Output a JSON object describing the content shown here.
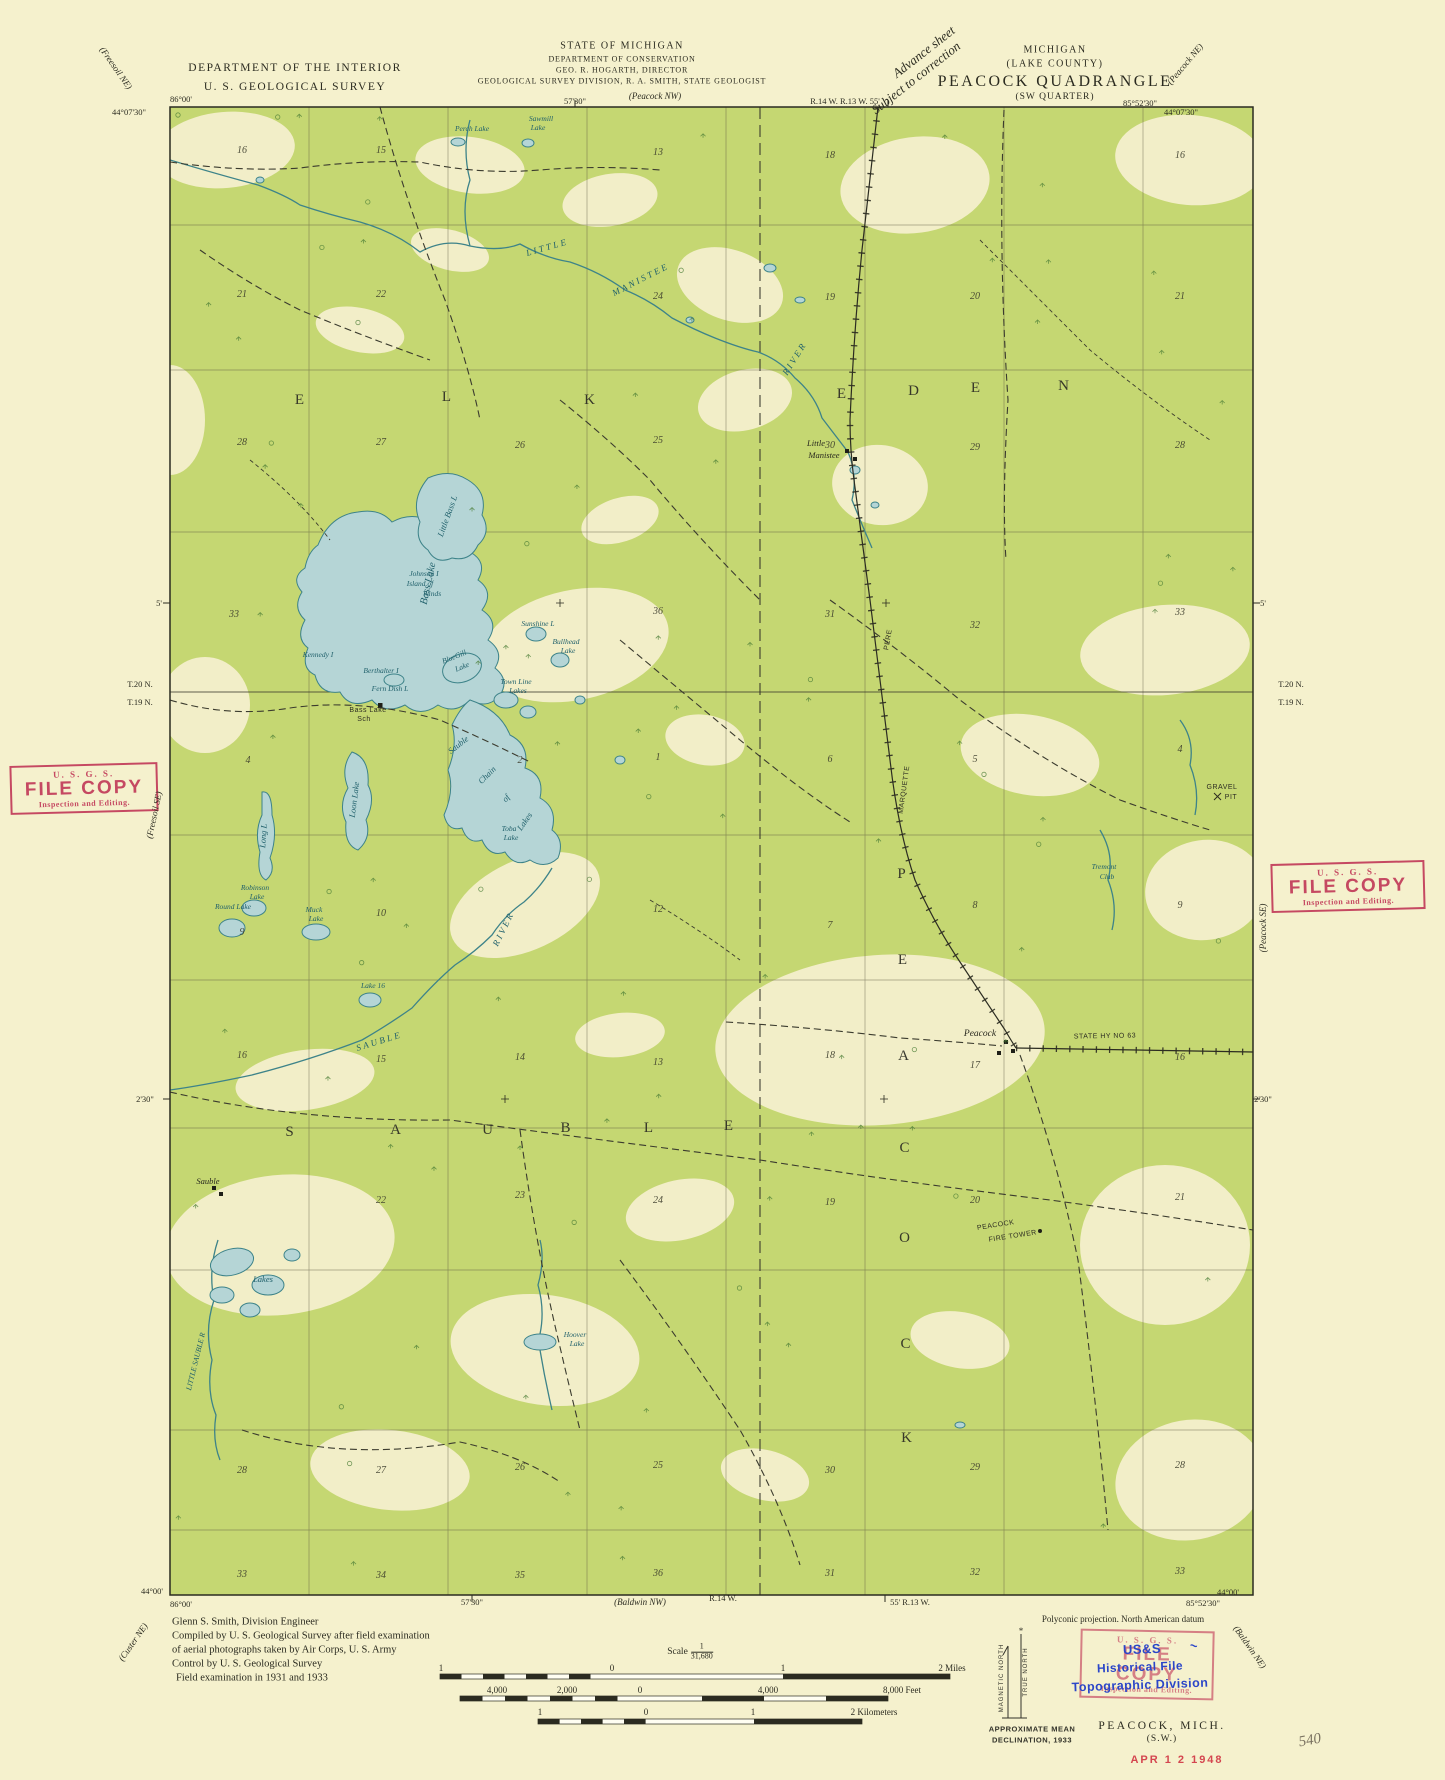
{
  "colors": {
    "paper": "#f5f1cd",
    "map_green": "#c5d772",
    "clearing": "#f2eec8",
    "water_fill": "#b5d5d6",
    "water_line": "#3d8389",
    "stamp_red": "#c23b59",
    "stamp_blue": "#2b46c8",
    "ink": "#2b2b20"
  },
  "header": {
    "dept1": "DEPARTMENT OF THE INTERIOR",
    "dept2": "U. S. GEOLOGICAL SURVEY",
    "state1": "STATE OF MICHIGAN",
    "state2": "DEPARTMENT OF CONSERVATION",
    "state3": "GEO. R. HOGARTH, DIRECTOR",
    "state4": "GEOLOGICAL SURVEY DIVISION, R. A. SMITH, STATE GEOLOGIST",
    "note1": "Advance sheet",
    "note2": "Subject to correction",
    "right1": "MICHIGAN",
    "right2": "(LAKE COUNTY)",
    "right3": "PEACOCK QUADRANGLE",
    "right4": "(SW QUARTER)"
  },
  "stamps": {
    "file_copy": {
      "l1": "U. S. G. S.",
      "l2": "FILE COPY",
      "l3": "Inspection and Editing."
    },
    "historical": {
      "b1": "US&S",
      "b2": "Historical File",
      "b3": "Topographic Division",
      "mark": "~"
    },
    "date": "APR 1 2 1948",
    "pencil": "540"
  },
  "scale": {
    "word": "Scale",
    "num": "1",
    "den": "31,680"
  },
  "floating_texts": [
    {
      "t": "86°00'",
      "x": 181,
      "y": 99
    },
    {
      "t": "44°07'30\"",
      "x": 129,
      "y": 112
    },
    {
      "t": "57'30\"",
      "x": 575,
      "y": 101
    },
    {
      "t": "(Peacock NW)",
      "x": 655,
      "y": 96,
      "c": "ital"
    },
    {
      "t": "R.14 W. R.13 W. 55'",
      "x": 845,
      "y": 101
    },
    {
      "t": "85°52'30\"",
      "x": 1140,
      "y": 103
    },
    {
      "t": "44°07'30\"",
      "x": 1181,
      "y": 112
    },
    {
      "t": "(Peacock NE)",
      "x": 1185,
      "y": 64,
      "r": -50,
      "c": "ital"
    },
    {
      "t": "(Freesoil NE)",
      "x": 116,
      "y": 68,
      "r": 55,
      "c": "ital"
    },
    {
      "t": "5'",
      "x": 159,
      "y": 603
    },
    {
      "t": "T.20 N.",
      "x": 140,
      "y": 684
    },
    {
      "t": "T.19 N.",
      "x": 140,
      "y": 702
    },
    {
      "t": "(Freesoil SE)",
      "x": 154,
      "y": 815,
      "r": -78,
      "c": "ital"
    },
    {
      "t": "2'30\"",
      "x": 145,
      "y": 1099
    },
    {
      "t": "(Custer NE)",
      "x": 133,
      "y": 1642,
      "r": -55,
      "c": "ital"
    },
    {
      "t": "5'",
      "x": 1263,
      "y": 603
    },
    {
      "t": "T.20 N.",
      "x": 1291,
      "y": 684
    },
    {
      "t": "T.19 N.",
      "x": 1291,
      "y": 702
    },
    {
      "t": "(Peacock SE)",
      "x": 1263,
      "y": 928,
      "r": -90,
      "c": "ital"
    },
    {
      "t": "2'30\"",
      "x": 1263,
      "y": 1099
    },
    {
      "t": "(Baldwin NE)",
      "x": 1250,
      "y": 1647,
      "r": 55,
      "c": "ital"
    },
    {
      "t": "44°00'",
      "x": 152,
      "y": 1591
    },
    {
      "t": "86°00'",
      "x": 181,
      "y": 1604
    },
    {
      "t": "57'30\"",
      "x": 472,
      "y": 1602
    },
    {
      "t": "(Baldwin NW)",
      "x": 640,
      "y": 1602,
      "c": "ital"
    },
    {
      "t": "R.14 W.",
      "x": 723,
      "y": 1598
    },
    {
      "t": "55' R.13 W.",
      "x": 910,
      "y": 1602
    },
    {
      "t": "85°52'30\"",
      "x": 1203,
      "y": 1603
    },
    {
      "t": "44°00'",
      "x": 1228,
      "y": 1592
    },
    {
      "t": "Glenn S. Smith, Division Engineer",
      "x": 172,
      "y": 1622,
      "c": "cred"
    },
    {
      "t": "Compiled by U. S. Geological Survey after field examination",
      "x": 172,
      "y": 1636,
      "c": "cred"
    },
    {
      "t": "of aerial photographs taken by Air Corps, U. S. Army",
      "x": 172,
      "y": 1650,
      "c": "cred"
    },
    {
      "t": "Control by U. S. Geological Survey",
      "x": 172,
      "y": 1664,
      "c": "cred"
    },
    {
      "t": "Field examination in 1931 and 1933",
      "x": 176,
      "y": 1678,
      "c": "cred"
    },
    {
      "t": "1",
      "x": 441,
      "y": 1668,
      "c": "scl"
    },
    {
      "t": "0",
      "x": 612,
      "y": 1668,
      "c": "scl"
    },
    {
      "t": "1",
      "x": 783,
      "y": 1668,
      "c": "scl"
    },
    {
      "t": "2 Miles",
      "x": 952,
      "y": 1668,
      "c": "scl"
    },
    {
      "t": "4,000",
      "x": 497,
      "y": 1690,
      "c": "scl"
    },
    {
      "t": "2,000",
      "x": 567,
      "y": 1690,
      "c": "scl"
    },
    {
      "t": "0",
      "x": 640,
      "y": 1690,
      "c": "scl"
    },
    {
      "t": "4,000",
      "x": 768,
      "y": 1690,
      "c": "scl"
    },
    {
      "t": "8,000 Feet",
      "x": 902,
      "y": 1690,
      "c": "scl"
    },
    {
      "t": "1",
      "x": 540,
      "y": 1712,
      "c": "scl"
    },
    {
      "t": "0",
      "x": 646,
      "y": 1712,
      "c": "scl"
    },
    {
      "t": "1",
      "x": 753,
      "y": 1712,
      "c": "scl"
    },
    {
      "t": "2 Kilometers",
      "x": 874,
      "y": 1712,
      "c": "scl"
    },
    {
      "t": "Polyconic projection.    North American datum",
      "x": 1123,
      "y": 1619,
      "c": "proj"
    },
    {
      "t": "MAGNETIC NORTH",
      "x": 1002,
      "y": 1678,
      "r": -90,
      "c": "decl2"
    },
    {
      "t": "TRUE NORTH",
      "x": 1026,
      "y": 1672,
      "r": -90,
      "c": "decl2"
    },
    {
      "t": "APPROXIMATE MEAN",
      "x": 1032,
      "y": 1729,
      "c": "decl"
    },
    {
      "t": "DECLINATION, 1933",
      "x": 1032,
      "y": 1740,
      "c": "decl"
    },
    {
      "t": "PEACOCK, MICH.",
      "x": 1162,
      "y": 1726,
      "c": "sheet"
    },
    {
      "t": "(S.W.)",
      "x": 1162,
      "y": 1739,
      "c": "sheet2"
    },
    {
      "t": "540",
      "x": 1310,
      "y": 1741,
      "r": -10,
      "c": "pencil"
    },
    {
      "t": "APR 1 2 1948",
      "x": 1177,
      "y": 1760,
      "c": "date"
    }
  ],
  "map_labels": [
    {
      "t": "Perch Lake",
      "x": 472,
      "y": 131,
      "c": "ws"
    },
    {
      "t": "Sawmill",
      "x": 541,
      "y": 121,
      "c": "ws"
    },
    {
      "t": "Lake",
      "x": 538,
      "y": 130,
      "c": "ws"
    },
    {
      "t": "LITTLE",
      "x": 548,
      "y": 250,
      "r": -16,
      "c": "wr"
    },
    {
      "t": "MANISTEE",
      "x": 642,
      "y": 282,
      "r": -27,
      "c": "wr"
    },
    {
      "t": "RIVER",
      "x": 797,
      "y": 360,
      "r": -58,
      "c": "wr"
    },
    {
      "t": "E",
      "x": 300,
      "y": 404,
      "c": "t"
    },
    {
      "t": "L",
      "x": 447,
      "y": 401,
      "c": "t"
    },
    {
      "t": "K",
      "x": 590,
      "y": 404,
      "c": "t"
    },
    {
      "t": "E",
      "x": 842,
      "y": 398,
      "c": "t"
    },
    {
      "t": "D",
      "x": 914,
      "y": 395,
      "c": "t"
    },
    {
      "t": "E",
      "x": 976,
      "y": 392,
      "c": "t"
    },
    {
      "t": "N",
      "x": 1064,
      "y": 390,
      "c": "t"
    },
    {
      "t": "Little",
      "x": 816,
      "y": 446,
      "c": "p"
    },
    {
      "t": "Manistee",
      "x": 824,
      "y": 458,
      "c": "p"
    },
    {
      "t": "Little Bass L",
      "x": 450,
      "y": 517,
      "r": -70,
      "c": "w"
    },
    {
      "t": "Bass Lake",
      "x": 431,
      "y": 584,
      "r": -78,
      "c": "w",
      "s": 10.5
    },
    {
      "t": "Johnson I",
      "x": 424,
      "y": 576,
      "c": "ws"
    },
    {
      "t": "Island of",
      "x": 420,
      "y": 586,
      "c": "ws"
    },
    {
      "t": "Winds",
      "x": 432,
      "y": 596,
      "c": "ws"
    },
    {
      "t": "Kennedy I",
      "x": 318,
      "y": 657,
      "c": "ws"
    },
    {
      "t": "Berthalter I",
      "x": 381,
      "y": 673,
      "c": "ws"
    },
    {
      "t": "Fern Dish L",
      "x": 390,
      "y": 691,
      "c": "ws"
    },
    {
      "t": "Bass Lake",
      "x": 368,
      "y": 712,
      "c": "ps"
    },
    {
      "t": "Sch",
      "x": 364,
      "y": 721,
      "c": "ps"
    },
    {
      "t": "BlueGill",
      "x": 455,
      "y": 659,
      "r": -22,
      "c": "ws"
    },
    {
      "t": "Lake",
      "x": 463,
      "y": 669,
      "r": -22,
      "c": "ws"
    },
    {
      "t": "Town Line",
      "x": 516,
      "y": 684,
      "c": "ws"
    },
    {
      "t": "Lakes",
      "x": 518,
      "y": 693,
      "c": "ws"
    },
    {
      "t": "Sunshine L",
      "x": 538,
      "y": 626,
      "c": "ws"
    },
    {
      "t": "Bullhead",
      "x": 566,
      "y": 644,
      "c": "ws"
    },
    {
      "t": "Lake",
      "x": 568,
      "y": 653,
      "c": "ws"
    },
    {
      "t": "Sauble",
      "x": 460,
      "y": 747,
      "r": -38,
      "c": "w"
    },
    {
      "t": "Chain",
      "x": 489,
      "y": 777,
      "r": -45,
      "c": "w"
    },
    {
      "t": "of",
      "x": 508,
      "y": 800,
      "r": -50,
      "c": "w"
    },
    {
      "t": "Lakes",
      "x": 527,
      "y": 823,
      "r": -55,
      "c": "w"
    },
    {
      "t": "Toba",
      "x": 509,
      "y": 831,
      "c": "ws"
    },
    {
      "t": "Lake",
      "x": 511,
      "y": 840,
      "c": "ws"
    },
    {
      "t": "Loon Lake",
      "x": 357,
      "y": 800,
      "r": -83,
      "c": "w"
    },
    {
      "t": "Long L",
      "x": 266,
      "y": 836,
      "r": -86,
      "c": "w"
    },
    {
      "t": "Robinson",
      "x": 255,
      "y": 890,
      "c": "ws"
    },
    {
      "t": "Lake",
      "x": 257,
      "y": 899,
      "c": "ws"
    },
    {
      "t": "Round Lake",
      "x": 233,
      "y": 909,
      "c": "ws"
    },
    {
      "t": "Muck",
      "x": 314,
      "y": 912,
      "c": "ws"
    },
    {
      "t": "Lake",
      "x": 316,
      "y": 921,
      "c": "ws"
    },
    {
      "t": "Lake 16",
      "x": 373,
      "y": 988,
      "c": "ws"
    },
    {
      "t": "RIVER",
      "x": 506,
      "y": 930,
      "r": -64,
      "c": "wr"
    },
    {
      "t": "SAUBLE",
      "x": 380,
      "y": 1044,
      "r": -17,
      "c": "wr"
    },
    {
      "t": "S",
      "x": 290,
      "y": 1136,
      "c": "t"
    },
    {
      "t": "A",
      "x": 396,
      "y": 1134,
      "c": "t"
    },
    {
      "t": "U",
      "x": 488,
      "y": 1134,
      "c": "t"
    },
    {
      "t": "B",
      "x": 566,
      "y": 1132,
      "c": "t"
    },
    {
      "t": "L",
      "x": 649,
      "y": 1132,
      "c": "t"
    },
    {
      "t": "E",
      "x": 729,
      "y": 1130,
      "c": "t"
    },
    {
      "t": "P",
      "x": 902,
      "y": 878,
      "c": "t"
    },
    {
      "t": "E",
      "x": 903,
      "y": 964,
      "c": "t"
    },
    {
      "t": "A",
      "x": 904,
      "y": 1060,
      "c": "t"
    },
    {
      "t": "C",
      "x": 905,
      "y": 1152,
      "c": "t"
    },
    {
      "t": "O",
      "x": 905,
      "y": 1242,
      "c": "t"
    },
    {
      "t": "C",
      "x": 906,
      "y": 1348,
      "c": "t"
    },
    {
      "t": "K",
      "x": 907,
      "y": 1442,
      "c": "t"
    },
    {
      "t": "PERE",
      "x": 890,
      "y": 640,
      "r": -80,
      "c": "ps"
    },
    {
      "t": "MARQUETTE",
      "x": 906,
      "y": 790,
      "r": -82,
      "c": "ps"
    },
    {
      "t": "Sauble",
      "x": 208,
      "y": 1184,
      "c": "p"
    },
    {
      "t": "Peacock",
      "x": 980,
      "y": 1036,
      "c": "p",
      "s": 9.5
    },
    {
      "t": "STATE  HY  NO 63",
      "x": 1105,
      "y": 1038,
      "r": -1,
      "c": "ps"
    },
    {
      "t": "GRAVEL",
      "x": 1222,
      "y": 789,
      "c": "ps"
    },
    {
      "t": "PIT",
      "x": 1231,
      "y": 799,
      "c": "ps"
    },
    {
      "t": "Tremont",
      "x": 1104,
      "y": 869,
      "c": "ws"
    },
    {
      "t": "Club",
      "x": 1107,
      "y": 879,
      "c": "ws"
    },
    {
      "t": "PEACOCK",
      "x": 996,
      "y": 1227,
      "r": -9,
      "c": "ps"
    },
    {
      "t": "FIRE TOWER",
      "x": 1013,
      "y": 1238,
      "r": -9,
      "c": "ps"
    },
    {
      "t": "Hoover",
      "x": 575,
      "y": 1337,
      "c": "ws"
    },
    {
      "t": "Lake",
      "x": 577,
      "y": 1346,
      "c": "ws"
    },
    {
      "t": "Lakes",
      "x": 263,
      "y": 1282,
      "c": "w"
    },
    {
      "t": "LITTLE SAUBLE R",
      "x": 198,
      "y": 1362,
      "r": -76,
      "c": "ws"
    }
  ],
  "sections": [
    {
      "n": "16",
      "x": 242,
      "y": 153
    },
    {
      "n": "15",
      "x": 381,
      "y": 153
    },
    {
      "n": "13",
      "x": 658,
      "y": 155
    },
    {
      "n": "18",
      "x": 830,
      "y": 158
    },
    {
      "n": "16",
      "x": 1180,
      "y": 158
    },
    {
      "n": "21",
      "x": 242,
      "y": 297
    },
    {
      "n": "22",
      "x": 381,
      "y": 297
    },
    {
      "n": "24",
      "x": 658,
      "y": 299
    },
    {
      "n": "19",
      "x": 830,
      "y": 300
    },
    {
      "n": "20",
      "x": 975,
      "y": 299
    },
    {
      "n": "21",
      "x": 1180,
      "y": 299
    },
    {
      "n": "28",
      "x": 242,
      "y": 445
    },
    {
      "n": "27",
      "x": 381,
      "y": 445
    },
    {
      "n": "26",
      "x": 520,
      "y": 448
    },
    {
      "n": "25",
      "x": 658,
      "y": 443
    },
    {
      "n": "30",
      "x": 830,
      "y": 448
    },
    {
      "n": "29",
      "x": 975,
      "y": 450
    },
    {
      "n": "28",
      "x": 1180,
      "y": 448
    },
    {
      "n": "33",
      "x": 234,
      "y": 617
    },
    {
      "n": "36",
      "x": 658,
      "y": 614
    },
    {
      "n": "31",
      "x": 830,
      "y": 617
    },
    {
      "n": "32",
      "x": 975,
      "y": 628
    },
    {
      "n": "33",
      "x": 1180,
      "y": 615
    },
    {
      "n": "4",
      "x": 248,
      "y": 763
    },
    {
      "n": "2",
      "x": 520,
      "y": 763
    },
    {
      "n": "1",
      "x": 658,
      "y": 760
    },
    {
      "n": "6",
      "x": 830,
      "y": 762
    },
    {
      "n": "5",
      "x": 975,
      "y": 762
    },
    {
      "n": "4",
      "x": 1180,
      "y": 752
    },
    {
      "n": "9",
      "x": 242,
      "y": 935
    },
    {
      "n": "10",
      "x": 381,
      "y": 916
    },
    {
      "n": "12",
      "x": 658,
      "y": 912
    },
    {
      "n": "7",
      "x": 830,
      "y": 928
    },
    {
      "n": "8",
      "x": 975,
      "y": 908
    },
    {
      "n": "9",
      "x": 1180,
      "y": 908
    },
    {
      "n": "16",
      "x": 242,
      "y": 1058
    },
    {
      "n": "15",
      "x": 381,
      "y": 1062
    },
    {
      "n": "14",
      "x": 520,
      "y": 1060
    },
    {
      "n": "13",
      "x": 658,
      "y": 1065
    },
    {
      "n": "18",
      "x": 830,
      "y": 1058
    },
    {
      "n": "17",
      "x": 975,
      "y": 1068
    },
    {
      "n": "16",
      "x": 1180,
      "y": 1060
    },
    {
      "n": "22",
      "x": 381,
      "y": 1203
    },
    {
      "n": "23",
      "x": 520,
      "y": 1198
    },
    {
      "n": "24",
      "x": 658,
      "y": 1203
    },
    {
      "n": "19",
      "x": 830,
      "y": 1205
    },
    {
      "n": "20",
      "x": 975,
      "y": 1203
    },
    {
      "n": "21",
      "x": 1180,
      "y": 1200
    },
    {
      "n": "28",
      "x": 242,
      "y": 1473
    },
    {
      "n": "27",
      "x": 381,
      "y": 1473
    },
    {
      "n": "26",
      "x": 520,
      "y": 1470
    },
    {
      "n": "25",
      "x": 658,
      "y": 1468
    },
    {
      "n": "30",
      "x": 830,
      "y": 1473
    },
    {
      "n": "29",
      "x": 975,
      "y": 1470
    },
    {
      "n": "28",
      "x": 1180,
      "y": 1468
    },
    {
      "n": "33",
      "x": 242,
      "y": 1577
    },
    {
      "n": "34",
      "x": 381,
      "y": 1578
    },
    {
      "n": "35",
      "x": 520,
      "y": 1578
    },
    {
      "n": "36",
      "x": 658,
      "y": 1576
    },
    {
      "n": "31",
      "x": 830,
      "y": 1576
    },
    {
      "n": "32",
      "x": 975,
      "y": 1575
    },
    {
      "n": "33",
      "x": 1180,
      "y": 1574
    }
  ]
}
